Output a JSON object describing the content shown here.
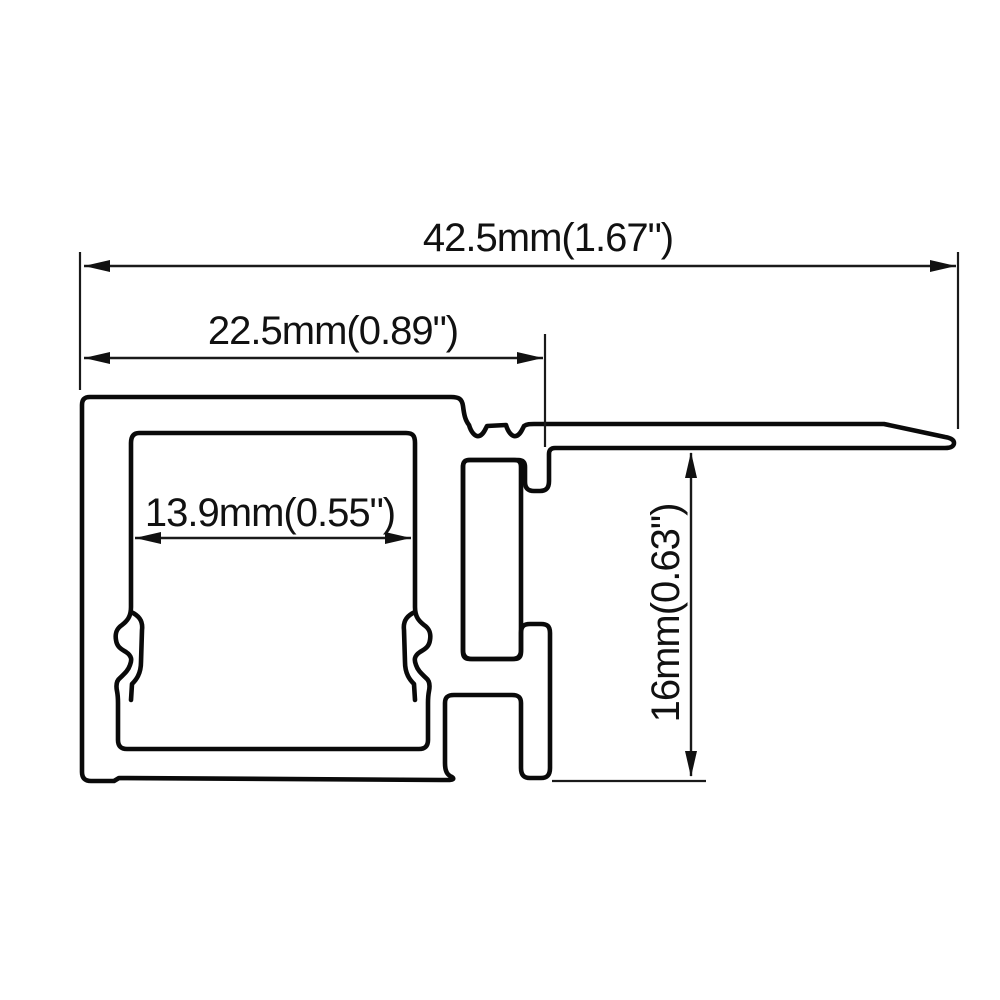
{
  "diagram": {
    "kind": "technical-drawing",
    "subject": "aluminum-led-profile-cross-section",
    "background_color": "#ffffff",
    "line_color": "#0a0a0a",
    "dimensions": [
      {
        "id": "overall-width",
        "label": "42.5mm(1.67\")",
        "value_mm": "42.5",
        "value_in": "1.67",
        "orientation": "horizontal"
      },
      {
        "id": "flange-offset-width",
        "label": "22.5mm(0.89\")",
        "value_mm": "22.5",
        "value_in": "0.89",
        "orientation": "horizontal"
      },
      {
        "id": "inner-channel-width",
        "label": "13.9mm(0.55\")",
        "value_mm": "13.9",
        "value_in": "0.55",
        "orientation": "horizontal"
      },
      {
        "id": "height",
        "label": "16mm(0.63\")",
        "value_mm": "16",
        "value_in": "0.63",
        "orientation": "vertical"
      }
    ]
  }
}
